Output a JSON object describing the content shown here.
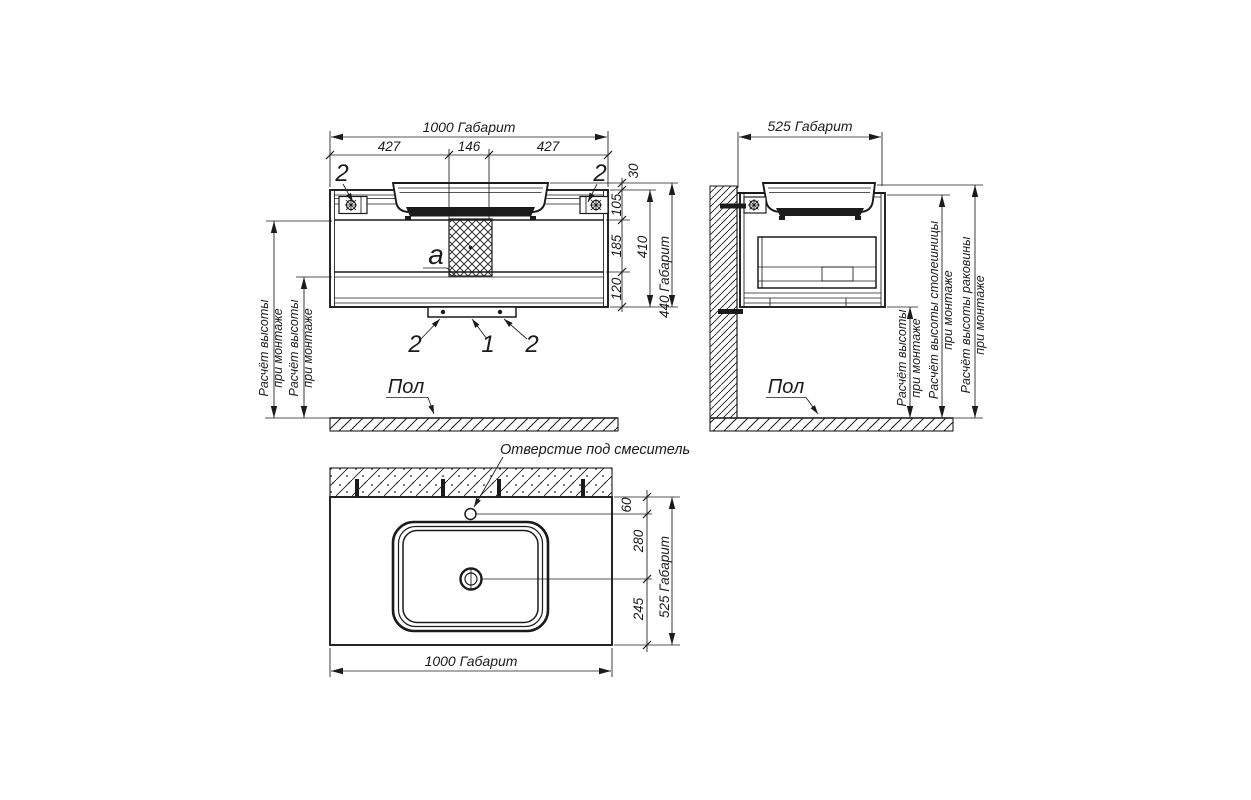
{
  "front": {
    "dim_width_total": "1000 Габарит",
    "dim_seg_left": "427",
    "dim_seg_center": "146",
    "dim_seg_right": "427",
    "dim_basin_lip": "30",
    "dim_top_section": "105",
    "dim_middle_section": "185",
    "dim_bottom_section": "120",
    "dim_body_height": "410",
    "dim_height_total": "440 Габарит",
    "callout_bracket_left": "2",
    "callout_bracket_right": "2",
    "callout_vent": "a",
    "callout_foot_left": "2",
    "callout_body": "1",
    "callout_foot_right": "2",
    "mount_note_1": {
      "line1": "Расчёт высоты",
      "line2": "при монтаже"
    },
    "mount_note_2": {
      "line1": "Расчёт высоты",
      "line2": "при монтаже"
    },
    "floor_label": "Пол"
  },
  "side": {
    "dim_depth_total": "525 Габарит",
    "mount_note": {
      "line1": "Расчёт высоты",
      "line2": "при монтаже"
    },
    "countertop_note": {
      "line1": "Расчёт высоты столешницы",
      "line2": "при монтаже"
    },
    "basin_note": {
      "line1": "Расчёт высоты раковины",
      "line2": "при монтаже"
    },
    "floor_label": "Пол"
  },
  "plan": {
    "faucet_hole_label": "Отверстие под смеситель",
    "dim_faucet_offset": "60",
    "dim_faucet_to_drain": "280",
    "dim_drain_to_front": "245",
    "dim_depth_total": "525 Габарит",
    "dim_width_total": "1000 Габарит"
  },
  "colors": {
    "ink": "#1b1b1b",
    "paper": "#ffffff"
  }
}
